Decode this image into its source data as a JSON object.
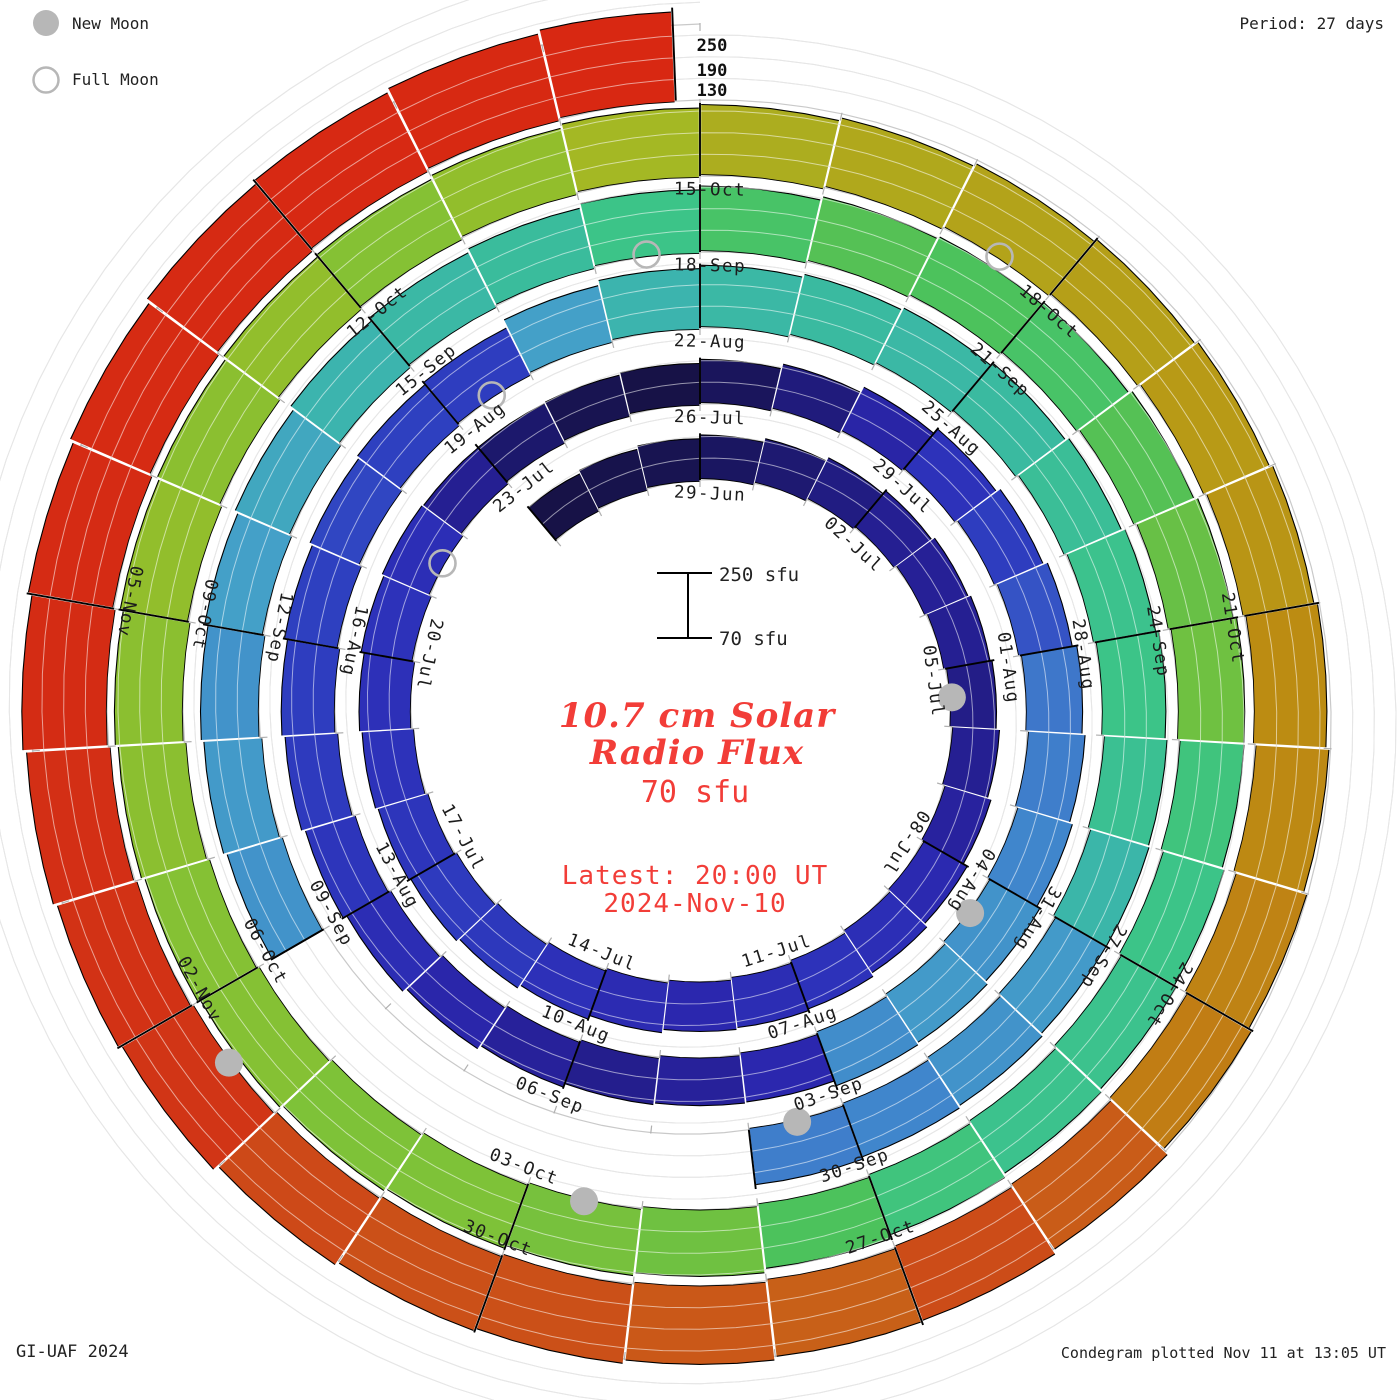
{
  "legend": {
    "new_moon": "New Moon",
    "full_moon": "Full Moon"
  },
  "header": {
    "period": "Period: 27 days"
  },
  "footer": {
    "credit": "GI-UAF 2024",
    "plotted": "Condegram plotted Nov 11 at 13:05 UT"
  },
  "center": {
    "title_line1": "10.7 cm Solar",
    "title_line2": "Radio Flux",
    "current_value": "70 sfu",
    "latest_line1": "Latest: 20:00 UT",
    "latest_line2": "2024-Nov-10",
    "scale_max_label": "250 sfu",
    "scale_min_label": "70 sfu"
  },
  "radial_axis": {
    "labels": [
      "250",
      "190",
      "130"
    ]
  },
  "chart_data": {
    "type": "spiral-bar",
    "title": "10.7 cm Solar Radio Flux Condegram",
    "start_date": "2024-06-26",
    "end_date": "2024-11-10",
    "days_per_revolution": 27,
    "flux_base": 70,
    "flux_full_scale": 250,
    "gridline_values": [
      130,
      190,
      250
    ],
    "date_labels": [
      "29-Jun",
      "02-Jul",
      "05-Jul",
      "08-Jul",
      "11-Jul",
      "14-Jul",
      "17-Jul",
      "20-Jul",
      "23-Jul",
      "26-Jul",
      "29-Jul",
      "01-Aug",
      "04-Aug",
      "07-Aug",
      "10-Aug",
      "13-Aug",
      "16-Aug",
      "19-Aug",
      "22-Aug",
      "25-Aug",
      "28-Aug",
      "31-Aug",
      "03-Sep",
      "06-Sep",
      "09-Sep",
      "12-Sep",
      "15-Sep",
      "18-Sep",
      "21-Sep",
      "24-Sep",
      "27-Sep",
      "30-Sep",
      "03-Oct",
      "06-Oct",
      "09-Oct",
      "12-Oct",
      "15-Oct",
      "18-Oct",
      "21-Oct",
      "24-Oct",
      "27-Oct",
      "30-Oct",
      "02-Nov",
      "05-Nov"
    ],
    "values": [
      186,
      187,
      188,
      191,
      194,
      197,
      200,
      201,
      200,
      198,
      200,
      203,
      208,
      211,
      213,
      210,
      207,
      209,
      212,
      215,
      216,
      214,
      213,
      212,
      213,
      211,
      200,
      193,
      188,
      186,
      190,
      196,
      205,
      213,
      217,
      221,
      226,
      227,
      228,
      230,
      231,
      229,
      207,
      202,
      199,
      202,
      206,
      210,
      214,
      216,
      217,
      218,
      219,
      218,
      217,
      232,
      238,
      240,
      241,
      240,
      241,
      243,
      245,
      246,
      244,
      239,
      231,
      230,
      228,
      227,
      null,
      null,
      null,
      null,
      null,
      230,
      231,
      230,
      232,
      234,
      238,
      240,
      242,
      246,
      249,
      251,
      250,
      249,
      251,
      253,
      254,
      247,
      246,
      245,
      245,
      247,
      250,
      254,
      255,
      256,
      256,
      257,
      257,
      258,
      258,
      259,
      258,
      259,
      257,
      259,
      262,
      264,
      265,
      266,
      267,
      268,
      269,
      271,
      272,
      274,
      276,
      286,
      290,
      285,
      287,
      289,
      289,
      291,
      298,
      300,
      302,
      304,
      307,
      310,
      313,
      315,
      317,
      319
    ],
    "new_moon_dates": [
      "2024-07-05",
      "2024-08-04",
      "2024-09-03",
      "2024-10-02",
      "2024-11-01"
    ],
    "full_moon_dates": [
      "2024-07-21",
      "2024-08-19",
      "2024-09-17",
      "2024-10-17"
    ],
    "colormap": [
      [
        184,
        "#15103c"
      ],
      [
        192,
        "#1b1766"
      ],
      [
        200,
        "#251f92"
      ],
      [
        207,
        "#2b27ae"
      ],
      [
        213,
        "#2d32ba"
      ],
      [
        218,
        "#2e40c0"
      ],
      [
        223,
        "#3a60c8"
      ],
      [
        228,
        "#4086cc"
      ],
      [
        232,
        "#44a0c8"
      ],
      [
        237,
        "#3cb2b2"
      ],
      [
        242,
        "#3abc9c"
      ],
      [
        246,
        "#3cc488"
      ],
      [
        250,
        "#4cc25c"
      ],
      [
        253,
        "#68c046"
      ],
      [
        256,
        "#7ec238"
      ],
      [
        259,
        "#92be2c"
      ],
      [
        262,
        "#a4b824"
      ],
      [
        265,
        "#b0a81c"
      ],
      [
        268,
        "#b89a16"
      ],
      [
        271,
        "#bc8c12"
      ],
      [
        275,
        "#c08014"
      ],
      [
        280,
        "#c47016"
      ],
      [
        285,
        "#c86018"
      ],
      [
        290,
        "#cc4c18"
      ],
      [
        296,
        "#d03816"
      ],
      [
        304,
        "#d42c14"
      ],
      [
        320,
        "#d82812"
      ]
    ],
    "colors": {
      "grid": "#c9c9c9",
      "tick": "#b0b0b0",
      "divider": "#000000",
      "moon": "#b7b7b7",
      "label_text": "#1c1c1c",
      "accent_red": "#f23d38"
    }
  }
}
